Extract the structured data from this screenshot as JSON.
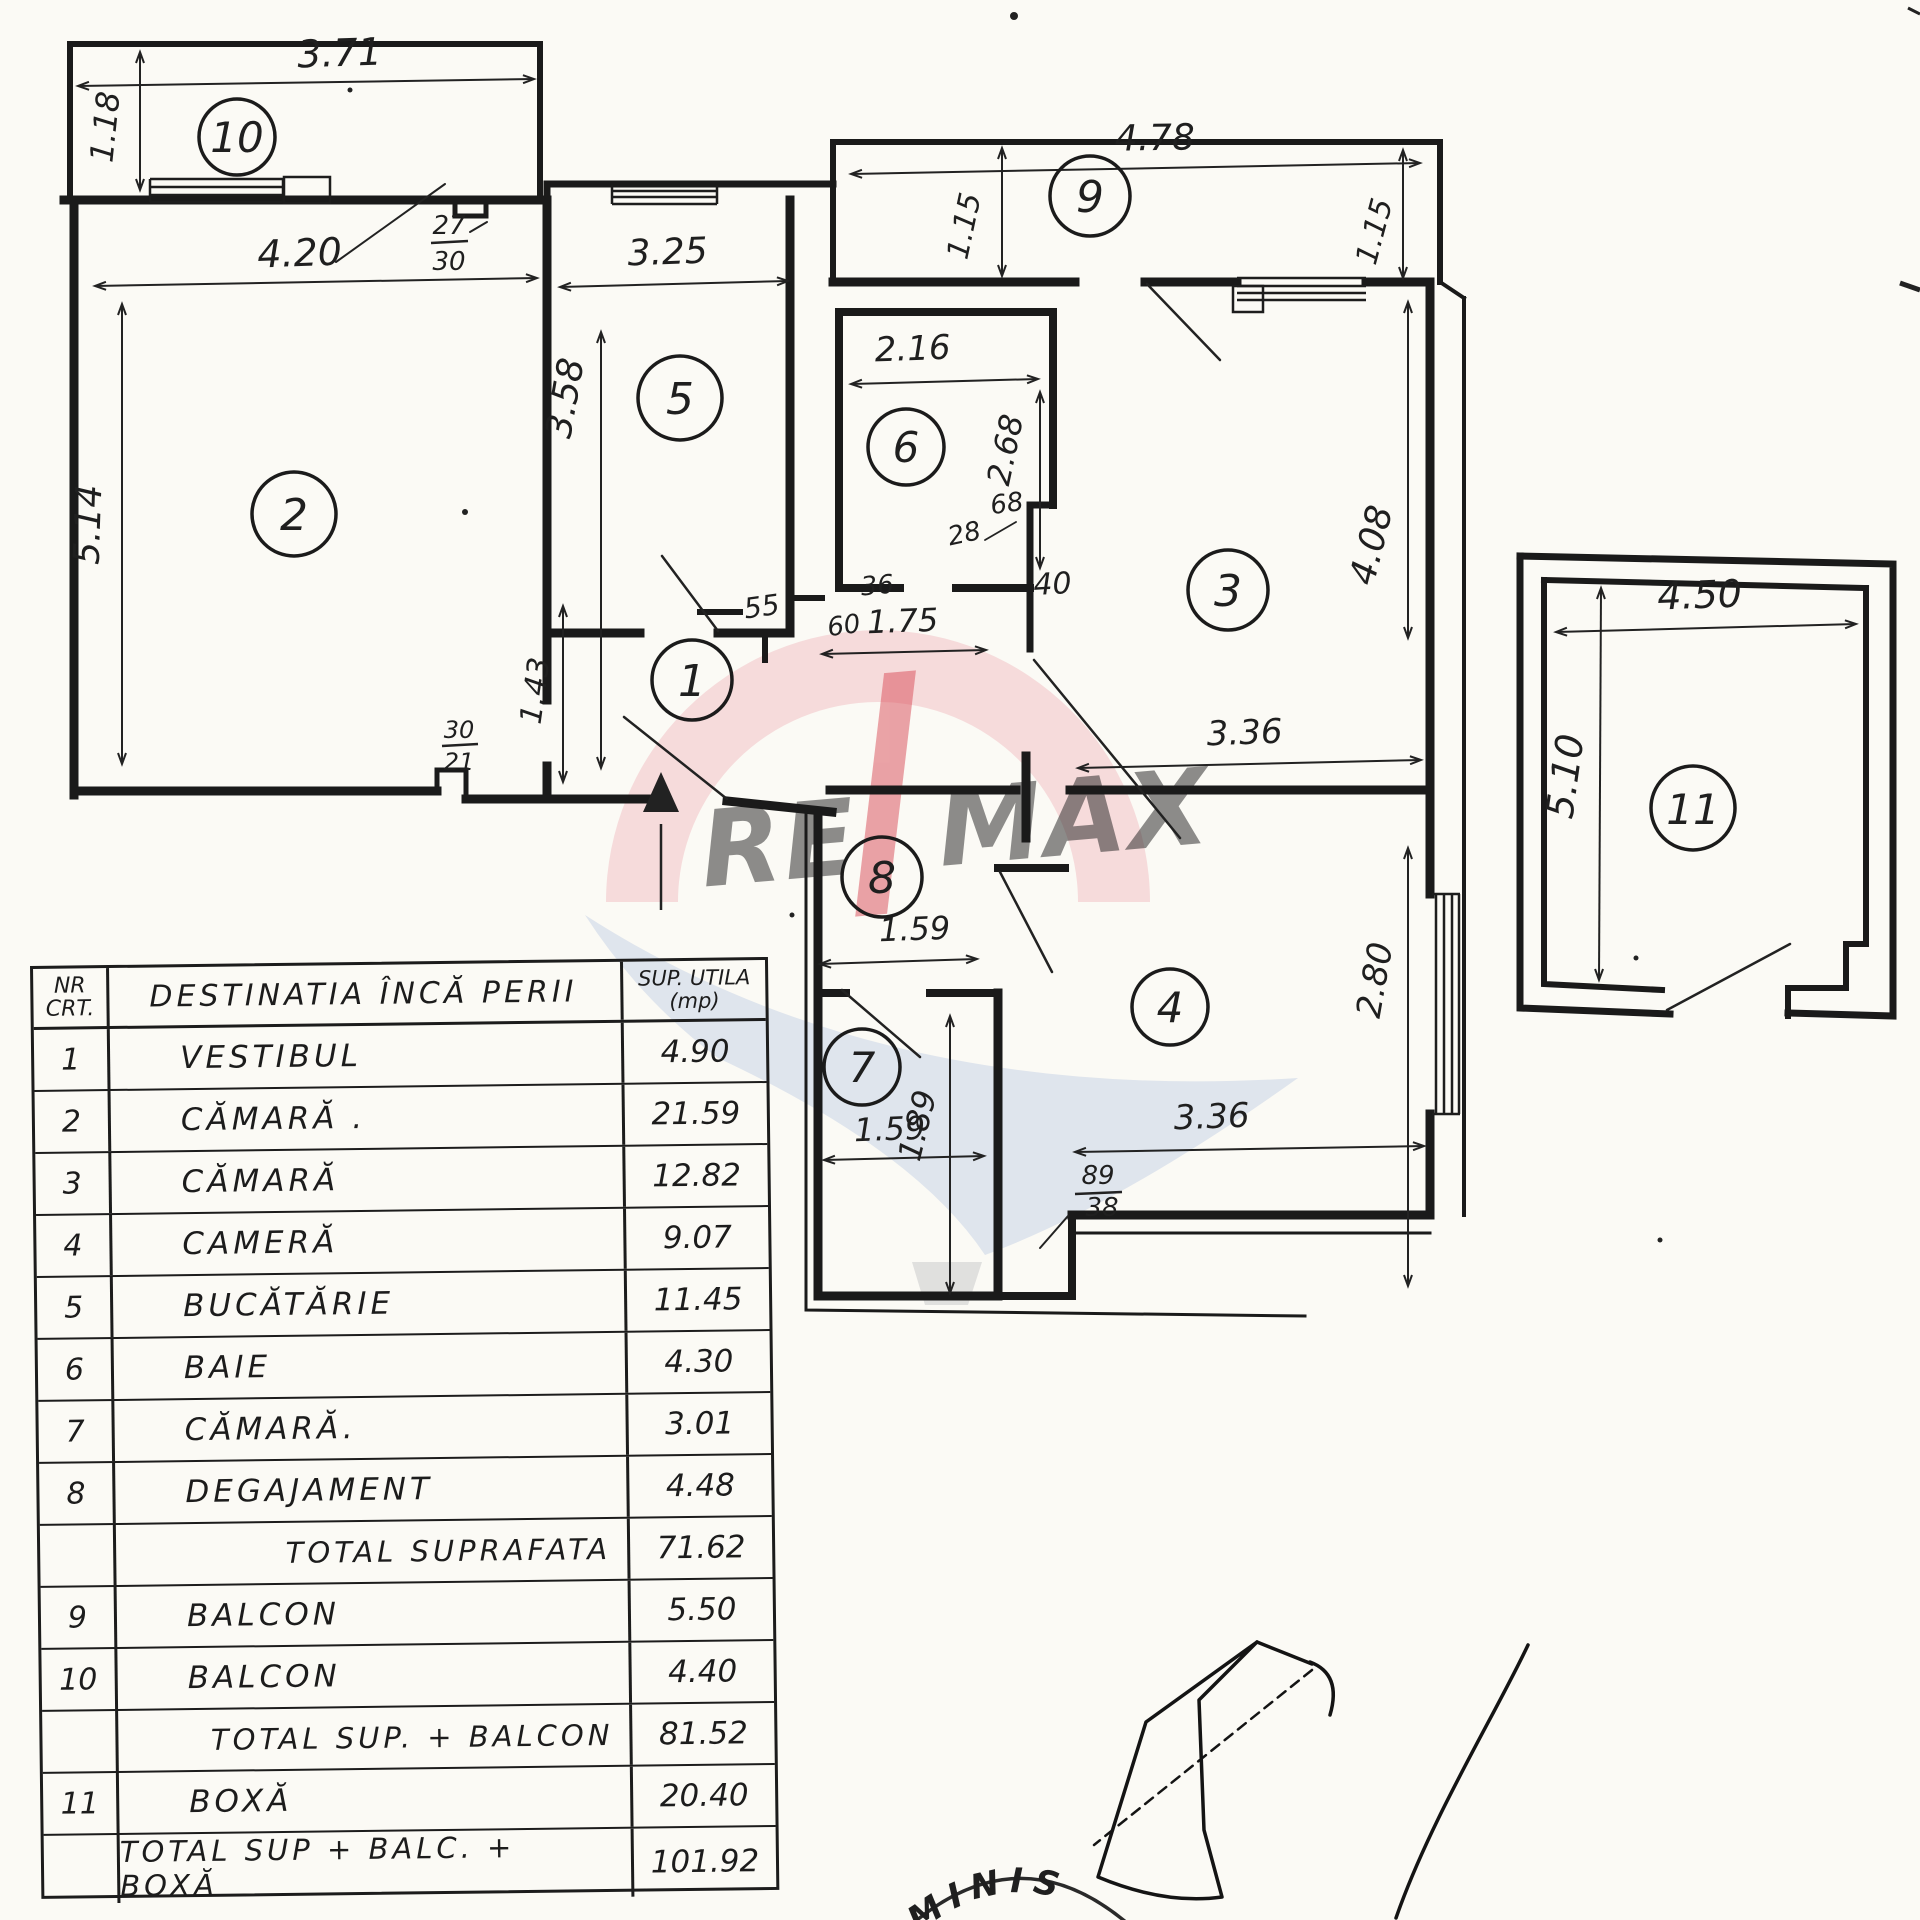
{
  "watermark": {
    "re": "RE",
    "max": "MAX",
    "red": "#d94b57",
    "blue": "#41639f",
    "pink": "#f0b6bc",
    "light_blue": "#c3d0e6"
  },
  "stamp": {
    "arc_text": "ADMINIS"
  },
  "plan": {
    "room_numbers": {
      "r1": "1",
      "r2": "2",
      "r3": "3",
      "r4": "4",
      "r5": "5",
      "r6": "6",
      "r7": "7",
      "r8": "8",
      "r9": "9",
      "r10": "10",
      "r11": "11"
    },
    "dims": {
      "d371": "3.71",
      "d118": "1.18",
      "d420": "4.20",
      "d514": "5.14",
      "d325": "3.25",
      "d358": "3.58",
      "d216": "2.16",
      "d268": "2.68",
      "d115a": "1.15",
      "d478": "4.78",
      "d115b": "1.15",
      "d408": "4.08",
      "d336a": "3.36",
      "d280": "2.80",
      "d336b": "3.36",
      "d159a": "1.59",
      "d189": "1.89",
      "d159b": "1.59",
      "d175": "1.75",
      "d143": "1.43",
      "d450": "4.50",
      "d510": "5.10",
      "s55": "55",
      "s60": "60",
      "s36": "36",
      "s40": "40",
      "s28": "28",
      "s68": "68",
      "f2730t": "27",
      "f2730b": "30",
      "f3021t": "30",
      "f3021b": "21",
      "f8938t": "89",
      "f8938b": "38"
    }
  },
  "table": {
    "header": {
      "nr_line1": "NR",
      "nr_line2": "CRT.",
      "dest": "DESTINATIA ÎNCĂ PERII",
      "sup_line1": "SUP. UTILA",
      "sup_line2": "(mp)"
    },
    "rows": [
      {
        "nr": "1",
        "dest": "VESTIBUL",
        "sup": "4.90"
      },
      {
        "nr": "2",
        "dest": "CĂMARĂ .",
        "sup": "21.59"
      },
      {
        "nr": "3",
        "dest": "CĂMARĂ",
        "sup": "12.82"
      },
      {
        "nr": "4",
        "dest": "CAMERĂ",
        "sup": "9.07"
      },
      {
        "nr": "5",
        "dest": "BUCĂTĂRIE",
        "sup": "11.45"
      },
      {
        "nr": "6",
        "dest": "BAIE",
        "sup": "4.30"
      },
      {
        "nr": "7",
        "dest": "CĂMARĂ.",
        "sup": "3.01"
      },
      {
        "nr": "8",
        "dest": "DEGAJAMENT",
        "sup": "4.48"
      },
      {
        "nr": "",
        "dest": "TOTAL SUPRAFATA",
        "sup": "71.62",
        "total": true
      },
      {
        "nr": "9",
        "dest": "BALCON",
        "sup": "5.50"
      },
      {
        "nr": "10",
        "dest": "BALCON",
        "sup": "4.40"
      },
      {
        "nr": "",
        "dest": "TOTAL SUP. + BALCON",
        "sup": "81.52",
        "total": true
      },
      {
        "nr": "11",
        "dest": "BOXĂ",
        "sup": "20.40"
      },
      {
        "nr": "",
        "dest": "TOTAL SUP + BALC. + BOXĂ",
        "sup": "101.92",
        "total": true
      }
    ]
  }
}
